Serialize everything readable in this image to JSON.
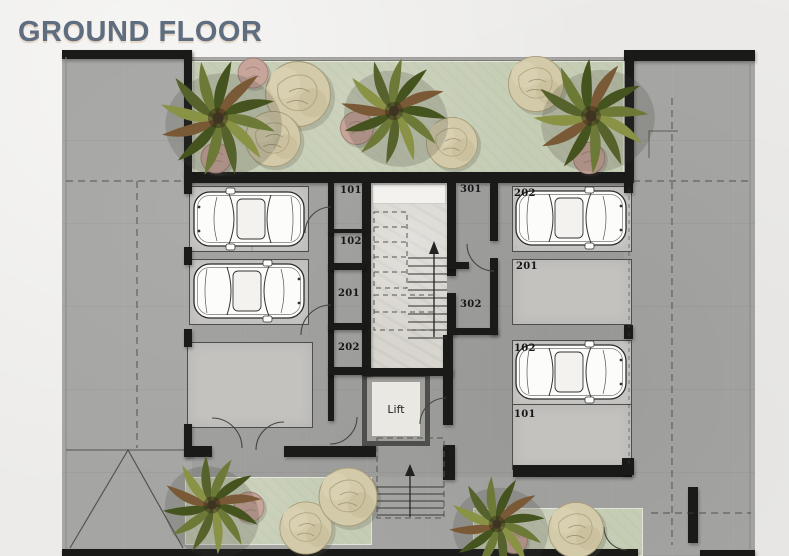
{
  "title": "GROUND FLOOR",
  "colors": {
    "title_text": "#5e6d7f",
    "walls": "#1a1a19",
    "concrete": "#a5a5a3",
    "garden_green": "#c6cdb5",
    "paper": "#ecebe9",
    "parking_fill": "#c9c8c5"
  },
  "lift": {
    "label": "Lift"
  },
  "rooms": {
    "storage": [
      {
        "id": "101"
      },
      {
        "id": "102"
      },
      {
        "id": "201"
      },
      {
        "id": "202"
      }
    ],
    "corridor": [
      {
        "id": "301"
      },
      {
        "id": "302"
      }
    ]
  },
  "parking": {
    "right": [
      {
        "id": "202",
        "occupied": true
      },
      {
        "id": "201",
        "occupied": false
      },
      {
        "id": "102",
        "occupied": true
      },
      {
        "id": "101",
        "occupied": false
      }
    ],
    "left": [
      {
        "occupied": true
      },
      {
        "occupied": true
      },
      {
        "occupied": false
      }
    ]
  }
}
